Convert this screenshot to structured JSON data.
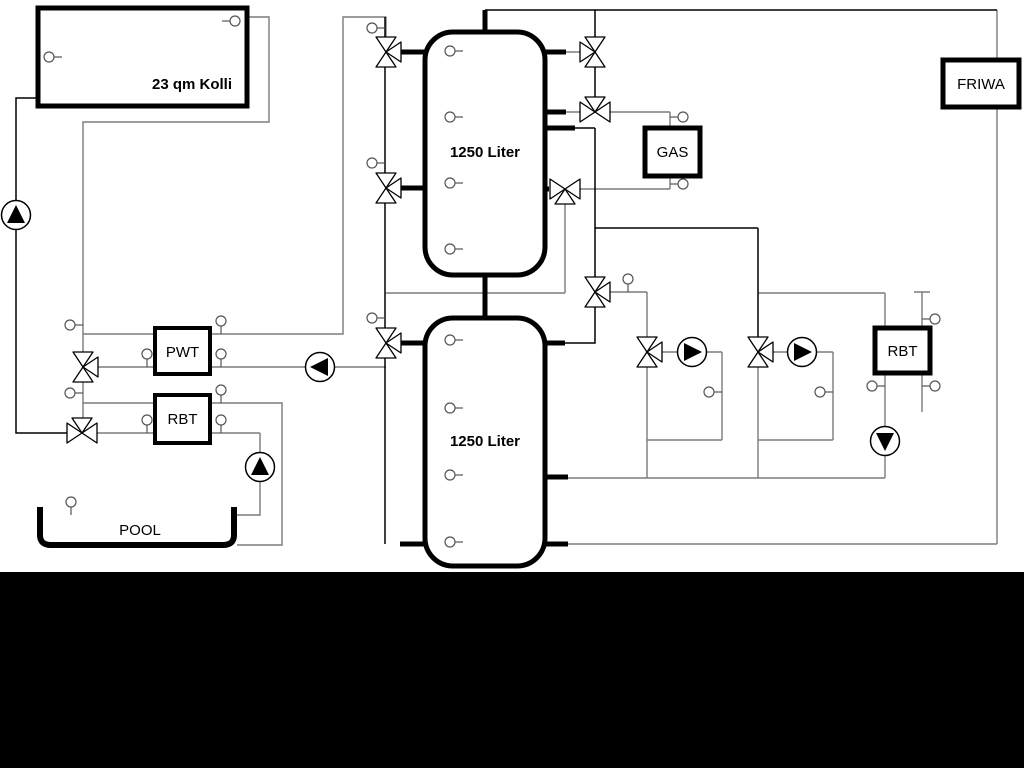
{
  "diagram": {
    "components": {
      "collector": {
        "label": "23 qm Kolli"
      },
      "tank_top": {
        "label": "1250 Liter"
      },
      "tank_bottom": {
        "label": "1250 Liter"
      },
      "pwt": {
        "label": "PWT"
      },
      "rbt_pool": {
        "label": "RBT"
      },
      "gas_boiler": {
        "label": "GAS"
      },
      "rbt_right": {
        "label": "RBT"
      },
      "friwa": {
        "label": "FRIWA"
      },
      "pool": {
        "label": "POOL"
      }
    },
    "colors": {
      "background": "#ffffff",
      "line_gray": "#7b7b7b",
      "line_black": "#000000",
      "footer_band": "#000000"
    }
  }
}
